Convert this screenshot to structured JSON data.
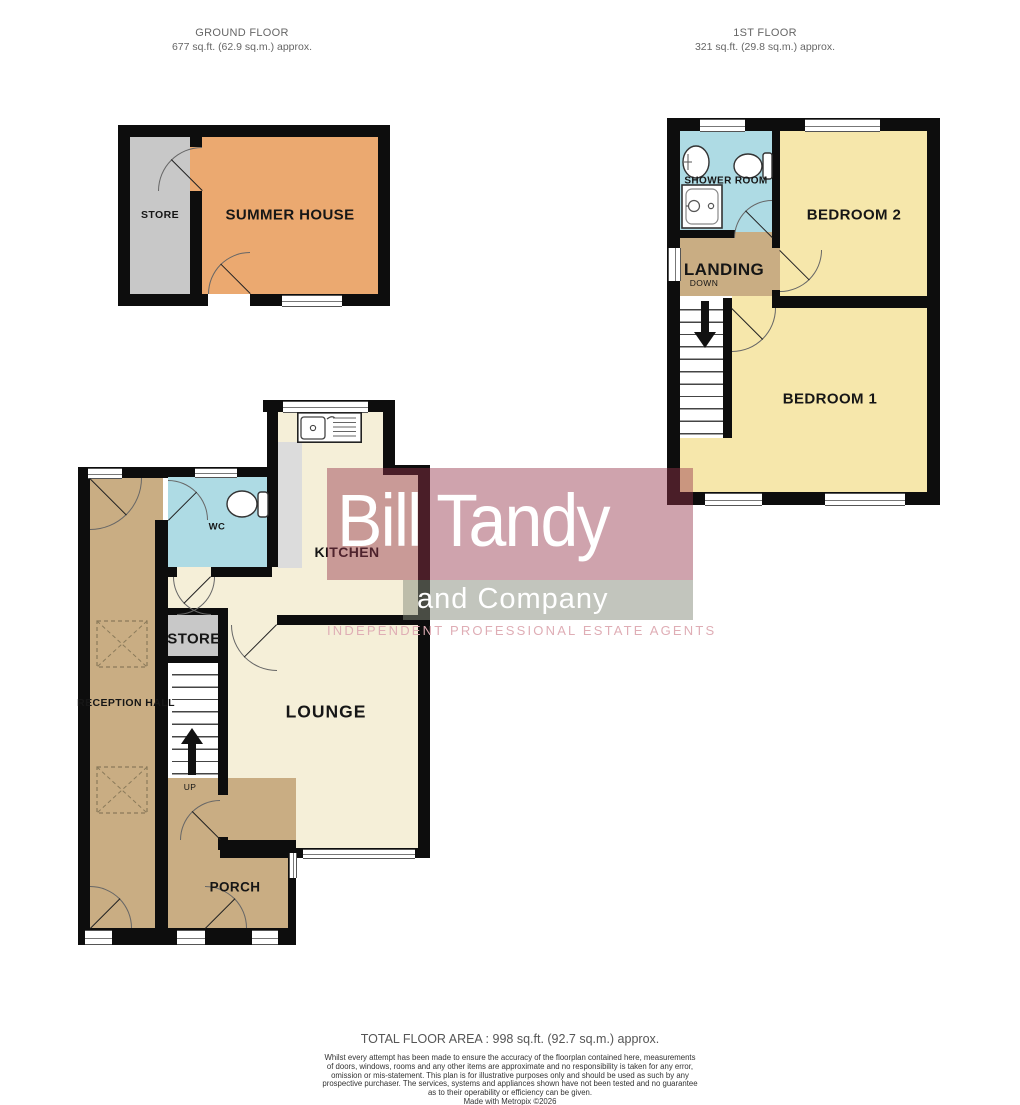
{
  "floors": {
    "ground": {
      "title": "GROUND FLOOR",
      "area": "677 sq.ft. (62.9 sq.m.) approx."
    },
    "first": {
      "title": "1ST FLOOR",
      "area": "321 sq.ft. (29.8 sq.m.) approx."
    }
  },
  "rooms": {
    "summer_store": "STORE",
    "summer_house": "SUMMER HOUSE",
    "shower_room": "SHOWER ROOM",
    "bedroom2": "BEDROOM 2",
    "landing": "LANDING",
    "down": "DOWN",
    "bedroom1": "BEDROOM 1",
    "wc": "WC",
    "kitchen": "KITCHEN",
    "reception_hall": "RECEPTION HALL",
    "store": "STORE",
    "up": "UP",
    "lounge": "LOUNGE",
    "porch": "PORCH"
  },
  "logo": {
    "name": "Bill Tandy",
    "suffix": "and Company",
    "tagline": "INDEPENDENT PROFESSIONAL ESTATE AGENTS"
  },
  "footer": {
    "total_area": "TOTAL FLOOR AREA : 998 sq.ft. (92.7 sq.m.) approx.",
    "disclaimer_lines": [
      "Whilst every attempt has been made to ensure the accuracy of the floorplan contained here, measurements",
      "of doors, windows, rooms and any other items are approximate and no responsibility is taken for any error,",
      "omission or mis-statement. This plan is for illustrative purposes only and should be used as such by any",
      "prospective purchaser. The services, systems and appliances shown have not been tested and no guarantee",
      "as to their operability or efficiency can be given."
    ],
    "credit": "Made with Metropix ©2026"
  },
  "colors": {
    "wall": "#0d0d0d",
    "cream": "#f5efd8",
    "yellow": "#f6e7ab",
    "tan": "#c9ad83",
    "blue": "#aedbe4",
    "gray": "#c8c8c8",
    "counter": "#dcdcdc",
    "orange": "#eba970",
    "logo_red": "rgba(148,51,73,0.45)",
    "logo_gray": "rgba(133,139,124,0.5)",
    "logo_tagline": "#dfadb5"
  }
}
